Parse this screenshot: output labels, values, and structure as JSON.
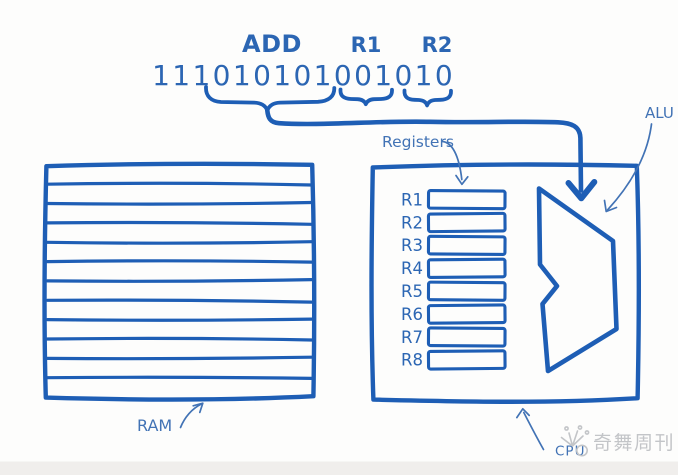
{
  "colors": {
    "ink": "#1e5eb5",
    "ink_text": "#2c66b3",
    "thin_labels": "#4273b5",
    "watermark": "#c3c5c8",
    "background": "#fdfdfc",
    "bottom_band": "#f0eeec"
  },
  "instruction": {
    "mnemonic": "ADD",
    "operands": [
      "R1",
      "R2"
    ],
    "binary": "111010101001010",
    "groups": [
      {
        "label": "ADD",
        "bits": "111010101"
      },
      {
        "label": "R1",
        "bits": "001"
      },
      {
        "label": "R2",
        "bits": "010"
      }
    ]
  },
  "cpu": {
    "label": "CPU",
    "registers_label": "Registers",
    "alu_label": "ALU",
    "registers": [
      "R1",
      "R2",
      "R3",
      "R4",
      "R5",
      "R6",
      "R7",
      "R8"
    ]
  },
  "ram": {
    "label": "RAM",
    "row_count": 12
  },
  "watermark": {
    "text": "奇舞周刊"
  }
}
